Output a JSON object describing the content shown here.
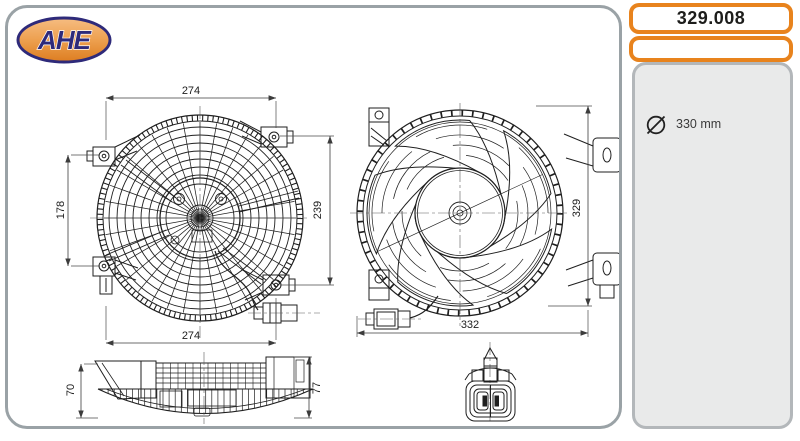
{
  "brand": {
    "name": "AHE"
  },
  "header": {
    "part_number": "329.008",
    "secondary_box_value": ""
  },
  "specs": {
    "diameter_icon": "diameter-icon",
    "diameter_value": "330 mm"
  },
  "dims": {
    "front_top": "274",
    "front_left": "178",
    "front_bottom": "274",
    "front_right": "239",
    "rear_right": "329",
    "rear_bottom": "332",
    "side_left": "70",
    "side_right": "77"
  },
  "colors": {
    "accent_orange": "#e8831d",
    "frame_gray": "#9aa2a6",
    "panel_gray": "#e9eaea",
    "logo_navy": "#2e2a7a",
    "logo_orange": "#e07c1a",
    "line_color": "#1f1f1f"
  }
}
